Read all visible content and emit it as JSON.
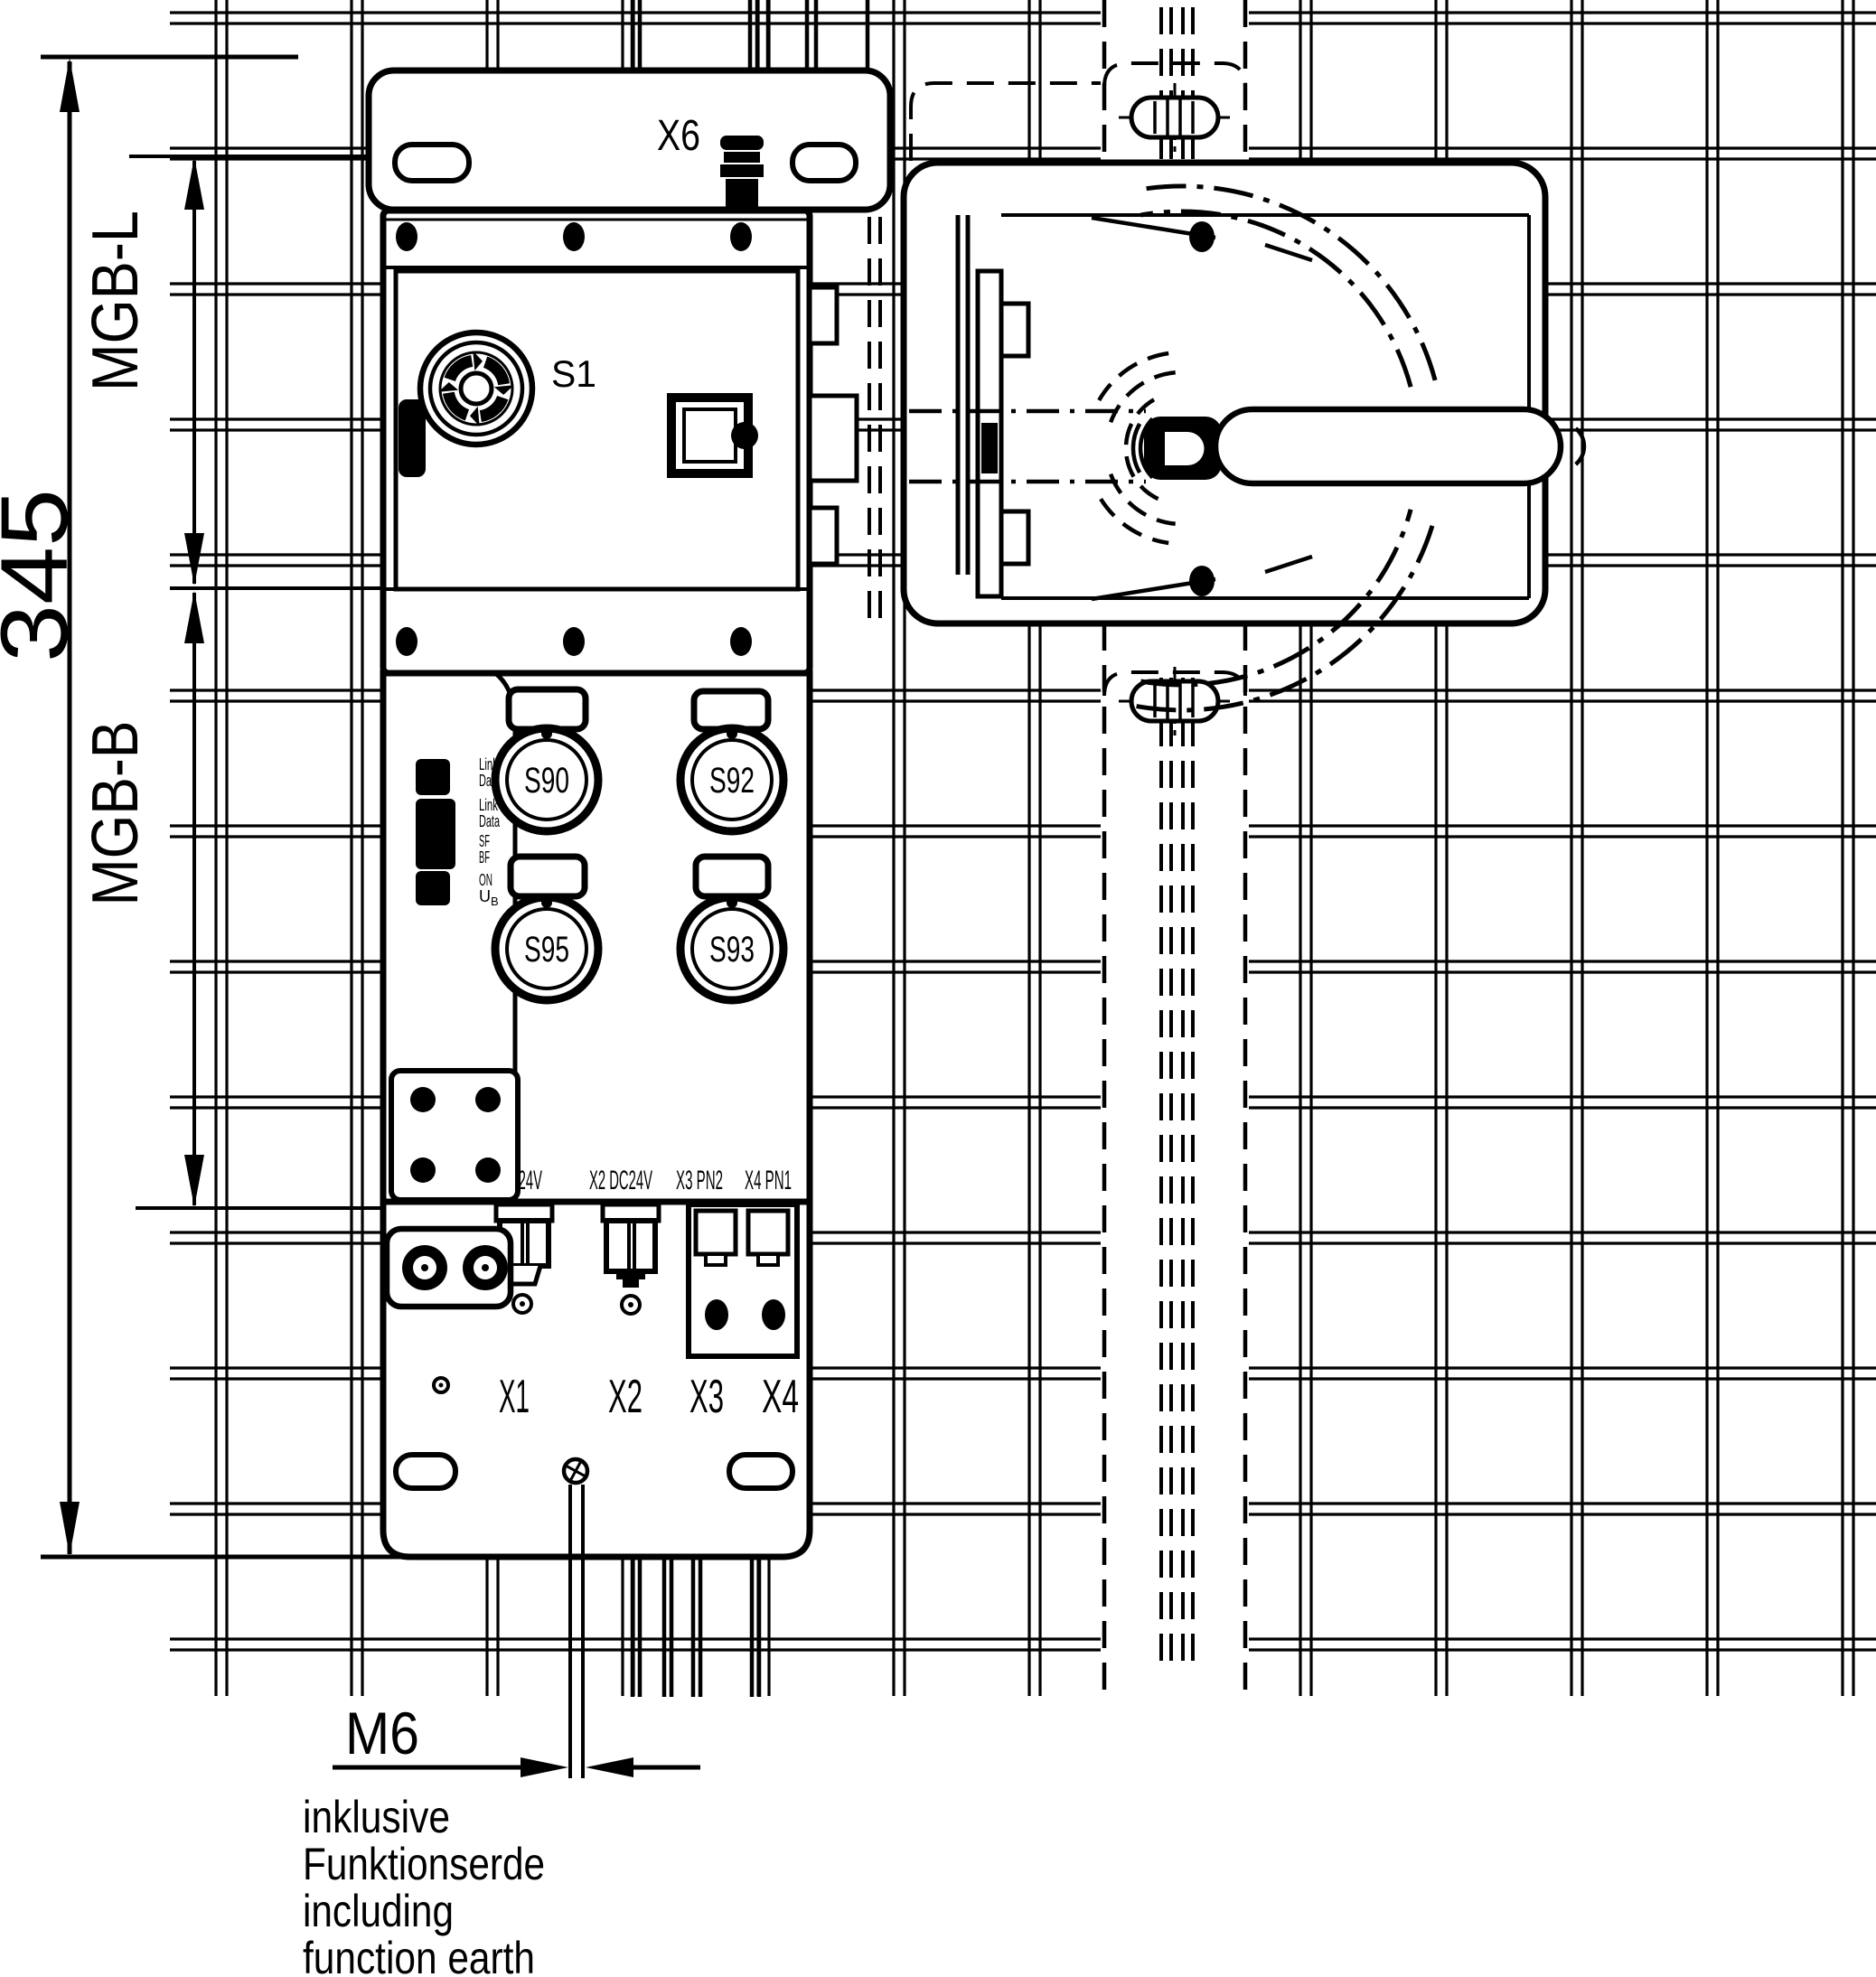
{
  "colors": {
    "line": "#000000",
    "background": "#ffffff"
  },
  "dims": {
    "overall": "345",
    "lock": "MGB-L",
    "bus": "MGB-B",
    "thread": "M6"
  },
  "unit": {
    "connector_top": "X6",
    "estop_label": "S1",
    "buttons": [
      "S90",
      "S92",
      "S95",
      "S93"
    ],
    "leds": [
      {
        "text": "Link"
      },
      {
        "text": "Data"
      },
      {
        "text": "Link"
      },
      {
        "text": "Data"
      },
      {
        "text": "SF"
      },
      {
        "text": "BF"
      },
      {
        "text": "ON"
      },
      {
        "text": "U",
        "sub": "B"
      }
    ],
    "ports": [
      "X1 DC24V",
      "X2 DC24V",
      "X3 PN2",
      "X4 PN1"
    ],
    "connectors": [
      "X1",
      "X2",
      "X3",
      "X4"
    ]
  },
  "note": {
    "lines": [
      "inklusive",
      "Funktionserde",
      "including",
      "function earth"
    ]
  }
}
